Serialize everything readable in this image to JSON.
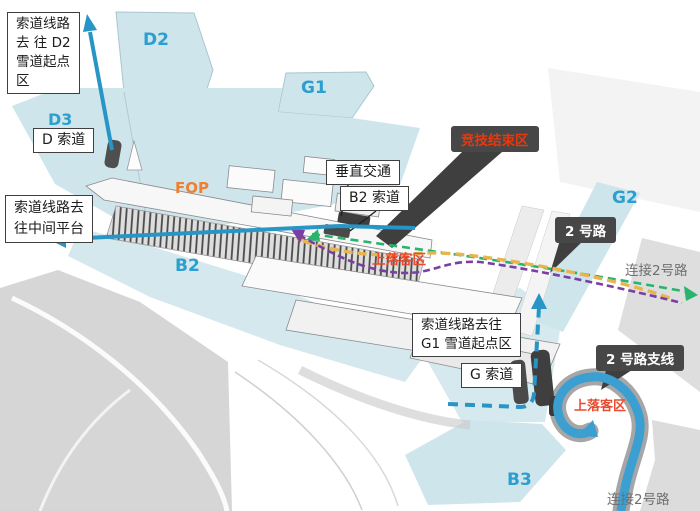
{
  "colors": {
    "slope": "#cfe5ec",
    "terrain_gray": "#d6d6d6",
    "blue_label": "#2a9fd0",
    "orange_label": "#f08030",
    "dropoff_label": "#e84b30",
    "red_label": "#e8380d",
    "gray_label": "#6f6f6f",
    "arrow_blue": "#2795c5",
    "loop_blue": "#3b9fd1",
    "road_green": "#28b46d",
    "road_yellow": "#e6b54e",
    "road_purple": "#7a3fa5",
    "dark_box_bg": "#474747"
  },
  "callouts": {
    "d2_route": [
      "索道线路",
      "去 往 D2",
      "雪道起点",
      "区"
    ],
    "mid_platform": [
      "索道线路去",
      "往中间平台"
    ],
    "g1_route": [
      "索道线路去往",
      "G1 雪道起点区"
    ],
    "d_cable": "D 索道",
    "vertical": "垂直交通",
    "b2_cable": "B2 索道",
    "g_cable": "G 索道"
  },
  "dark_callouts": {
    "finish": "竞技结束区",
    "road2": "2 号路",
    "road2_branch": "2 号路支线"
  },
  "regions": {
    "d2": "D2",
    "d3": "D3",
    "g1": "G1",
    "g2": "G2",
    "b2": "B2",
    "b3": "B3",
    "fop": "FOP"
  },
  "dropoff": {
    "a": "上落客区",
    "b": "上落客区"
  },
  "connect": {
    "a": "连接2号路",
    "b": "连接2号路"
  }
}
